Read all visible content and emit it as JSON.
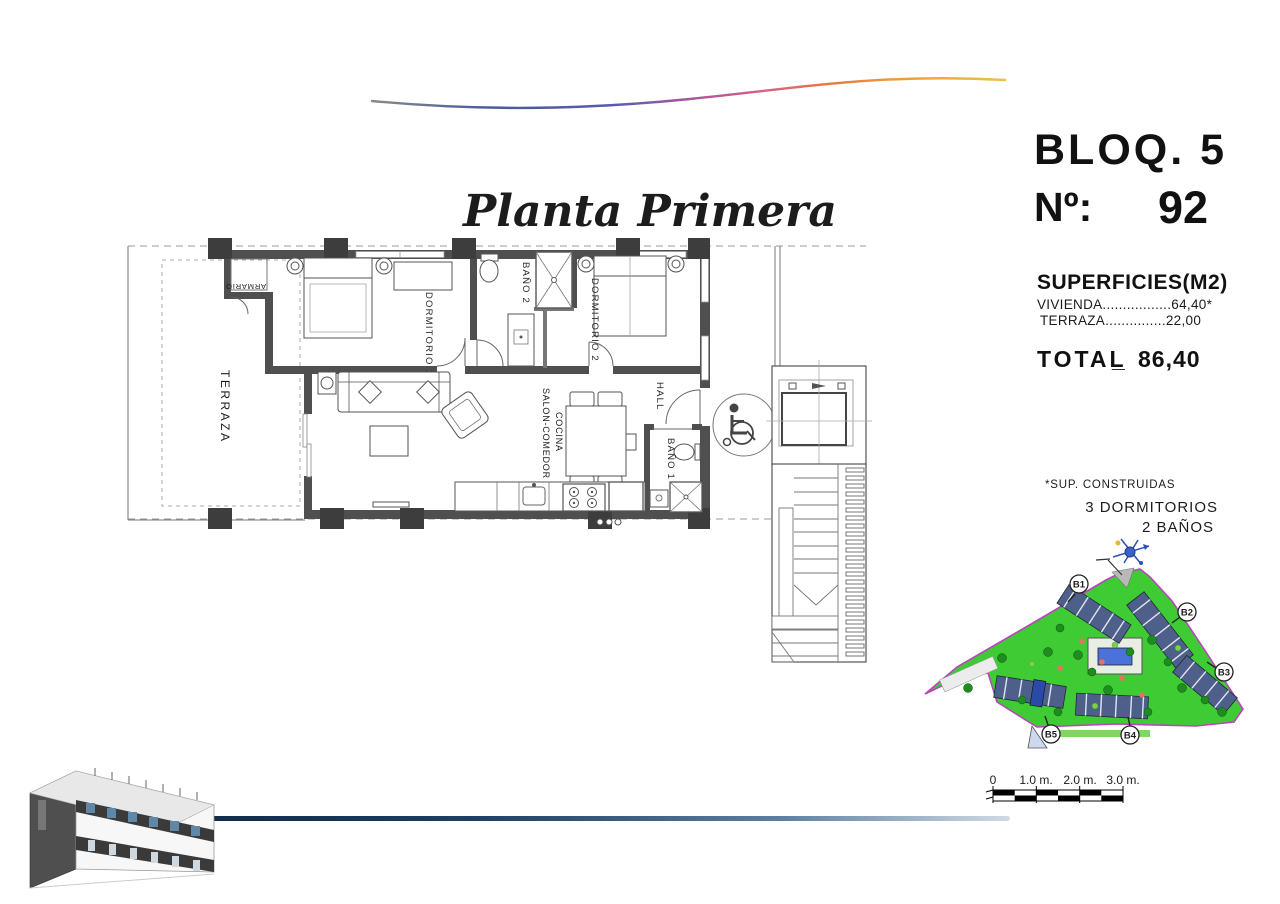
{
  "title": "Planta Primera",
  "info_panel": {
    "block": "BLOQ. 5",
    "unit_label": "Nº:",
    "unit_value": "92",
    "surfaces_heading": "SUPERFICIES(M2)",
    "vivienda_row": "VIVIENDA.................64,40*",
    "terraza_row": "TERRAZA...............22,00",
    "vivienda_value": "64,40",
    "terraza_value": "22,00",
    "total_label": "TOTAL",
    "total_sep": "_",
    "total_value": "86,40"
  },
  "notes": {
    "construidas": "*SUP. CONSTRUIDAS",
    "dormitorios": "3 DORMITORIOS",
    "banos": "2 BAÑOS"
  },
  "plan": {
    "labels": {
      "terraza": "TERRAZA",
      "armario": "ARMARIO",
      "dorm1": "DORMITORIO 1",
      "bano2": "BAÑO 2",
      "dorm2": "DORMITORIO 2",
      "salon": "SALON-COMEDOR",
      "cocina": "COCINA",
      "hall": "HALL",
      "bano1": "BAÑO 1"
    }
  },
  "site_plan": {
    "labels": {
      "b1": "B1",
      "b2": "B2",
      "b3": "B3",
      "b4": "B4",
      "b5": "B5"
    }
  },
  "scale_bar": {
    "labels": [
      "0",
      "1.0 m.",
      "2.0 m.",
      "3.0 m."
    ]
  },
  "colors": {
    "site_green": "#3ecb34",
    "site_border": "#bb44bb",
    "pool_blue": "#4a72d8",
    "line_blue": "#1d3f63",
    "wall_gray": "#4f4f4f"
  }
}
